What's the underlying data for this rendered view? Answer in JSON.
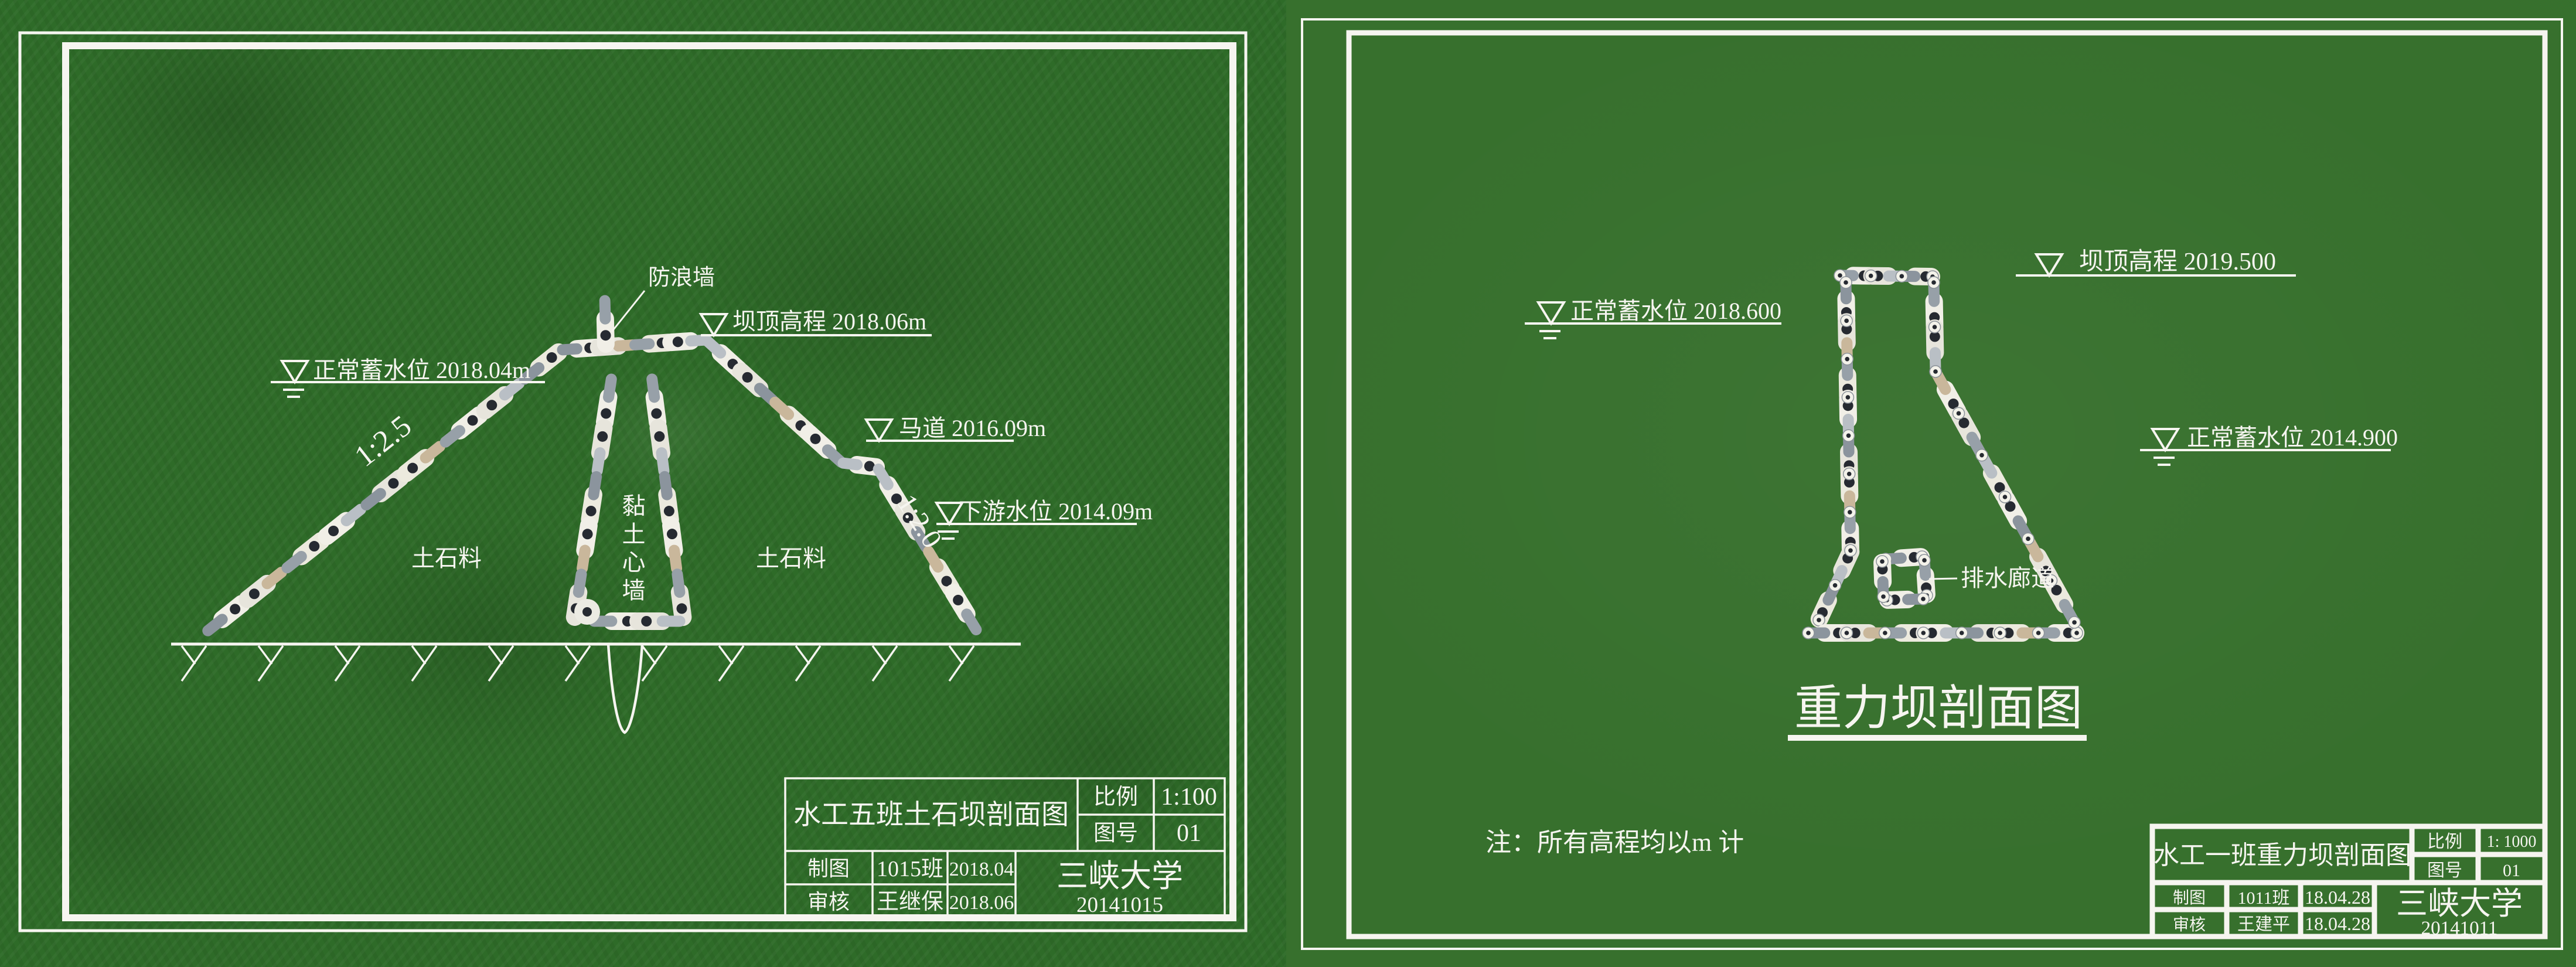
{
  "colors": {
    "field_green": "#2e6b28",
    "sheet_green": "#37702d",
    "line_white": "#f6f5f0",
    "head_dark": "#262a31"
  },
  "left_sheet": {
    "annotations": {
      "wave_wall": "防浪墙",
      "crest_elevation": "坝顶高程 2018.06m",
      "normal_water_level": "正常蓄水位 2018.04m",
      "berm": "马道 2016.09m",
      "downstream_water_level": "下游水位 2014.09m",
      "upstream_slope": "1:2.5",
      "downstream_slope": "1:2.0",
      "shell_material_left": "土石料",
      "shell_material_right": "土石料",
      "clay_core": "黏土心墙"
    },
    "title_block": {
      "title": "水工五班土石坝剖面图",
      "scale_label": "比例",
      "scale_value": "1:100",
      "sheet_no_label": "图号",
      "sheet_no_value": "01",
      "drafted_label": "制图",
      "drafted_by": "1015班",
      "drafted_date": "2018.04",
      "checked_label": "审核",
      "checked_by": "王继保",
      "checked_date": "2018.06",
      "organization": "三峡大学",
      "organization_no": "20141015"
    }
  },
  "right_sheet": {
    "annotations": {
      "crest_elevation": "坝顶高程 2019.500",
      "upstream_water_level": "正常蓄水位 2018.600",
      "downstream_water_level": "正常蓄水位 2014.900",
      "drainage_gallery": "排水廊道",
      "figure_title": "重力坝剖面图",
      "note": "注：所有高程均以m 计"
    },
    "title_block": {
      "title": "水工一班重力坝剖面图",
      "scale_label": "比例",
      "scale_value": "1: 1000",
      "sheet_no_label": "图号",
      "sheet_no_value": "01",
      "drafted_label": "制图",
      "drafted_by": "1011班",
      "drafted_date": "18.04.28",
      "checked_label": "审核",
      "checked_by": "王建平",
      "checked_date": "18.04.28",
      "organization": "三峡大学",
      "organization_no": "20141011"
    }
  }
}
